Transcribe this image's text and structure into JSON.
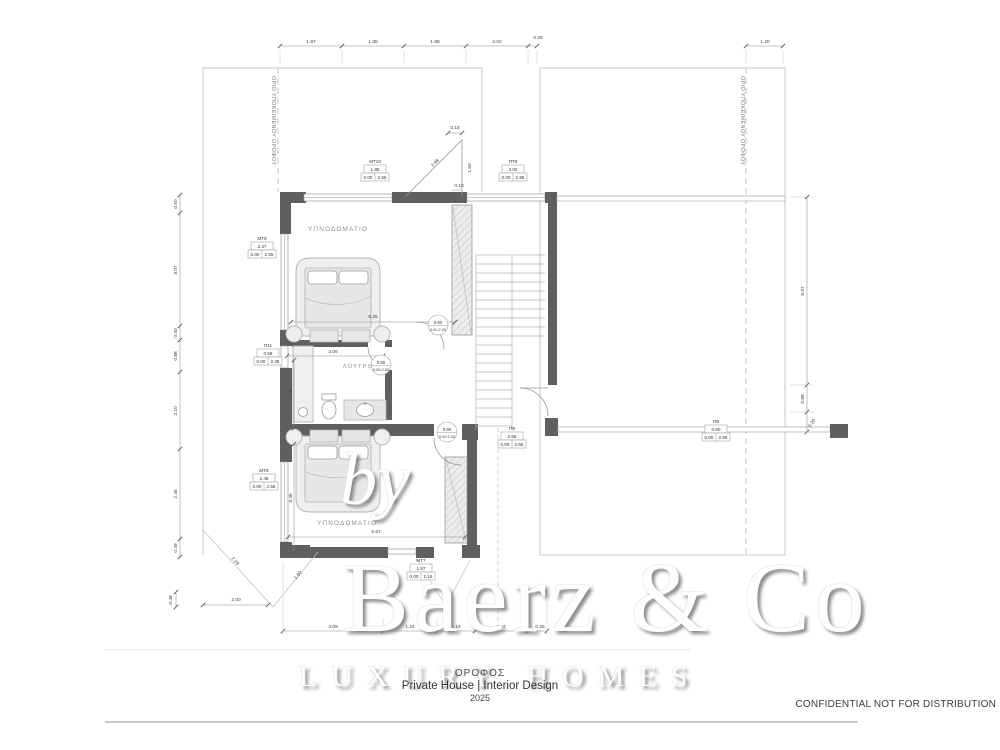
{
  "boundary": {
    "left_label": "ΟΡΙΟ ΥΠΟΚΕΙΜΕΝΟΥ ΟΡΟΦΟΥ",
    "right_label": "ΟΡΙΟ ΥΠΟΚΕΙΜΕΝΟΥ ΟΡΟΦΟΥ"
  },
  "rooms": {
    "bedroom_top": "ΥΠΝΟΔΩΜΑΤΙΟ",
    "bathroom": "ΛΟΥΤΡΟ",
    "bedroom_bottom": "ΥΠΝΟΔΩΜΑΤΙΟ"
  },
  "dims": {
    "top": [
      "1.97",
      "1.85",
      "1.98",
      "2.02",
      "0.28"
    ],
    "top_right": "1.20",
    "left": [
      "0.50",
      "3.07",
      "0.40",
      "0.88",
      "2.10",
      "2.46",
      "0.49"
    ],
    "bottom": [
      "3.09",
      "1.24",
      "1.16",
      "2.02",
      "0.25"
    ],
    "right": [
      "6.07",
      "0.88",
      "0.20"
    ],
    "bed1_width": "5.25",
    "bath_width": "3.06",
    "bath_depth": "2.18",
    "bed2_height": "3.46",
    "bed2_width": "5.67",
    "skylight": {
      "offset": "0.15",
      "slope": "3.48",
      "height": "1.50",
      "gap": "0.10"
    },
    "terrace": {
      "edge_a": "2.29",
      "edge_b": "1.60",
      "width": "2.00",
      "offset": "0.48"
    }
  },
  "opening_tags": [
    {
      "code": "ΜΤ10",
      "width": "1.88",
      "sill": "0.00",
      "height": "2.55"
    },
    {
      "code": "ΠΤ8",
      "width": "3.02",
      "sill": "0.00",
      "height": "2.55"
    },
    {
      "code": "ΜΤ9",
      "width": "2.37",
      "sill": "0.00",
      "height": "2.55"
    },
    {
      "code": "Π11",
      "width": "0.56",
      "sill": "0.00",
      "height": "2.38"
    },
    {
      "code": "ΜΤ8",
      "width": "2.48",
      "sill": "0.00",
      "height": "2.55"
    },
    {
      "code": "Π9",
      "width": "2.66",
      "sill": "0.00",
      "height": "2.55"
    },
    {
      "code": "Π8",
      "width": "0.60",
      "sill": "0.00",
      "height": "2.55"
    },
    {
      "code": "ΜΤ7",
      "width": "1.57",
      "sill": "0.00",
      "height": "2.16"
    }
  ],
  "door_tags": {
    "width": "0.80",
    "levels": "0.00 2.20"
  },
  "title_block": {
    "floor": "ΟΡΟΦΟΣ",
    "project": "Private House | Interior Design",
    "year": "2025"
  },
  "watermark": {
    "by": "by",
    "brand": "Baerz & Co",
    "tagline": "LUXURY HOMES"
  },
  "footer": {
    "confidential": "CONFIDENTIAL NOT FOR DISTRIBUTION"
  }
}
